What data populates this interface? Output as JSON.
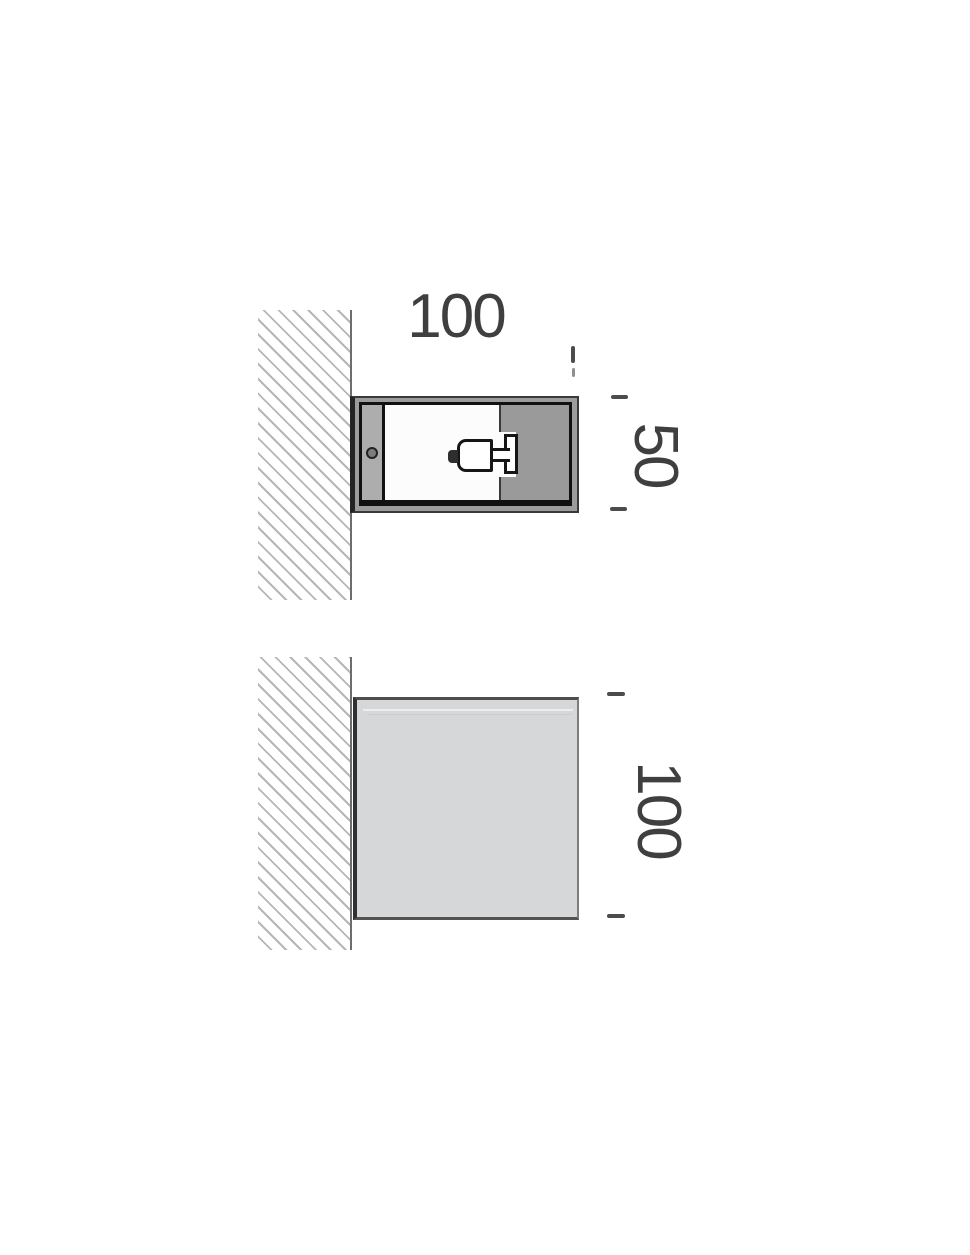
{
  "dims": {
    "top_width": "100",
    "top_depth": "50",
    "front_height": "100"
  },
  "colors": {
    "dimension_text": "#3f3f3f",
    "wall_hatch": "#b6b6b6",
    "wall_edge": "#6d6d6d",
    "drawing_line": "#111111",
    "housing_frame": "#9c9c9c",
    "mount_strip": "#adadad",
    "interior_panel_gray": "#9a9a9a",
    "interior_white": "#fcfcfc",
    "front_face_gray": "#d5d7d8",
    "tick_mark": "#4c4c4c"
  }
}
